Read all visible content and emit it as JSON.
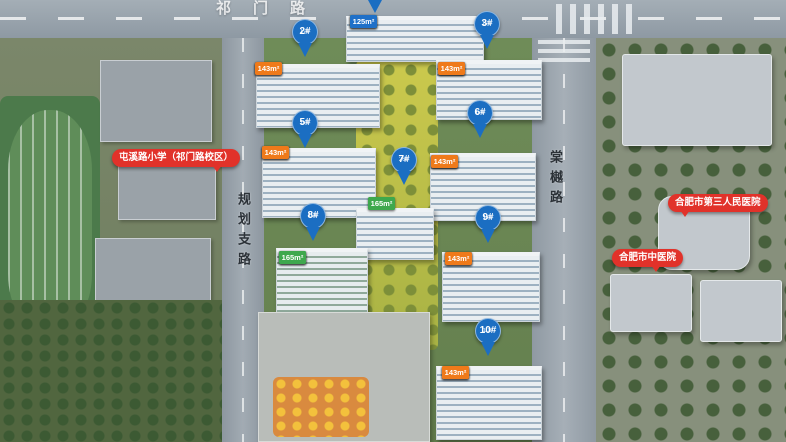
{
  "map": {
    "roads": {
      "top_label": "祁门路",
      "left_label": "规划支路",
      "right_label": "棠樾路"
    },
    "colors": {
      "marker_blue": "#1b6ec2",
      "tag_orange": "#ef7a1a",
      "tag_blue": "#1f70c8",
      "tag_green": "#3ea84d",
      "bubble_red": "#e1322a"
    },
    "markers": [
      {
        "label": "2#",
        "floors": "17F",
        "x": 305,
        "y": 19
      },
      {
        "label": "3#",
        "floors": "17F",
        "x": 487,
        "y": 11
      },
      {
        "label": "5#",
        "floors": "17F",
        "x": 305,
        "y": 110
      },
      {
        "label": "6#",
        "floors": "17F",
        "x": 480,
        "y": 100
      },
      {
        "label": "7#",
        "floors": "26F",
        "x": 404,
        "y": 147
      },
      {
        "label": "8#",
        "floors": "10F",
        "x": 313,
        "y": 203
      },
      {
        "label": "9#",
        "floors": "17F",
        "x": 488,
        "y": 205
      },
      {
        "label": "10#",
        "floors": "10F",
        "x": 488,
        "y": 318
      }
    ],
    "tag_rows": [
      {
        "x": 350,
        "y": 15,
        "tags": [
          {
            "text": "125m²",
            "color": "blue"
          },
          {
            "text": "165m²",
            "color": "green"
          },
          {
            "text": "165m²",
            "color": "green"
          },
          {
            "text": "125m²",
            "color": "blue"
          }
        ]
      },
      {
        "x": 255,
        "y": 62,
        "tags": [
          {
            "text": "143m²",
            "color": "orange"
          },
          {
            "text": "128m²",
            "color": "blue"
          },
          {
            "text": "128m²",
            "color": "blue"
          },
          {
            "text": "143m²",
            "color": "orange"
          }
        ]
      },
      {
        "x": 438,
        "y": 62,
        "tags": [
          {
            "text": "143m²",
            "color": "orange"
          },
          {
            "text": "125m²",
            "color": "blue"
          },
          {
            "text": "125m²",
            "color": "blue"
          },
          {
            "text": "143m²",
            "color": "orange"
          }
        ]
      },
      {
        "x": 262,
        "y": 146,
        "tags": [
          {
            "text": "143m²",
            "color": "orange"
          },
          {
            "text": "125m²",
            "color": "blue"
          },
          {
            "text": "125m²",
            "color": "blue"
          },
          {
            "text": "143m²",
            "color": "orange"
          }
        ]
      },
      {
        "x": 431,
        "y": 155,
        "tags": [
          {
            "text": "143m²",
            "color": "orange"
          },
          {
            "text": "125m²",
            "color": "blue"
          },
          {
            "text": "125m²",
            "color": "blue"
          },
          {
            "text": "143m²",
            "color": "orange"
          }
        ]
      },
      {
        "x": 368,
        "y": 197,
        "tags": [
          {
            "text": "165m²",
            "color": "green"
          },
          {
            "text": "165m²",
            "color": "green"
          }
        ]
      },
      {
        "x": 279,
        "y": 251,
        "tags": [
          {
            "text": "165m²",
            "color": "green"
          },
          {
            "text": "165m²",
            "color": "green"
          },
          {
            "text": "165m²",
            "color": "green"
          },
          {
            "text": "165m²",
            "color": "green"
          }
        ]
      },
      {
        "x": 445,
        "y": 252,
        "tags": [
          {
            "text": "143m²",
            "color": "orange"
          },
          {
            "text": "121m²",
            "color": "blue"
          },
          {
            "text": "125m²",
            "color": "blue"
          },
          {
            "text": "143m²",
            "color": "orange"
          }
        ]
      },
      {
        "x": 442,
        "y": 366,
        "tags": [
          {
            "text": "143m²",
            "color": "orange"
          },
          {
            "text": "143m²",
            "color": "orange"
          },
          {
            "text": "143m²",
            "color": "orange"
          },
          {
            "text": "143m²",
            "color": "orange"
          }
        ]
      }
    ],
    "bubbles": [
      {
        "text": "屯溪路小学（祁门路校区）",
        "x": 112,
        "y": 149,
        "tail": "tail-br"
      },
      {
        "text": "合肥市第三人民医院",
        "x": 668,
        "y": 194,
        "tail": "tail-bl"
      },
      {
        "text": "合肥市中医院",
        "x": 612,
        "y": 249,
        "tail": "tail-bd"
      }
    ]
  }
}
